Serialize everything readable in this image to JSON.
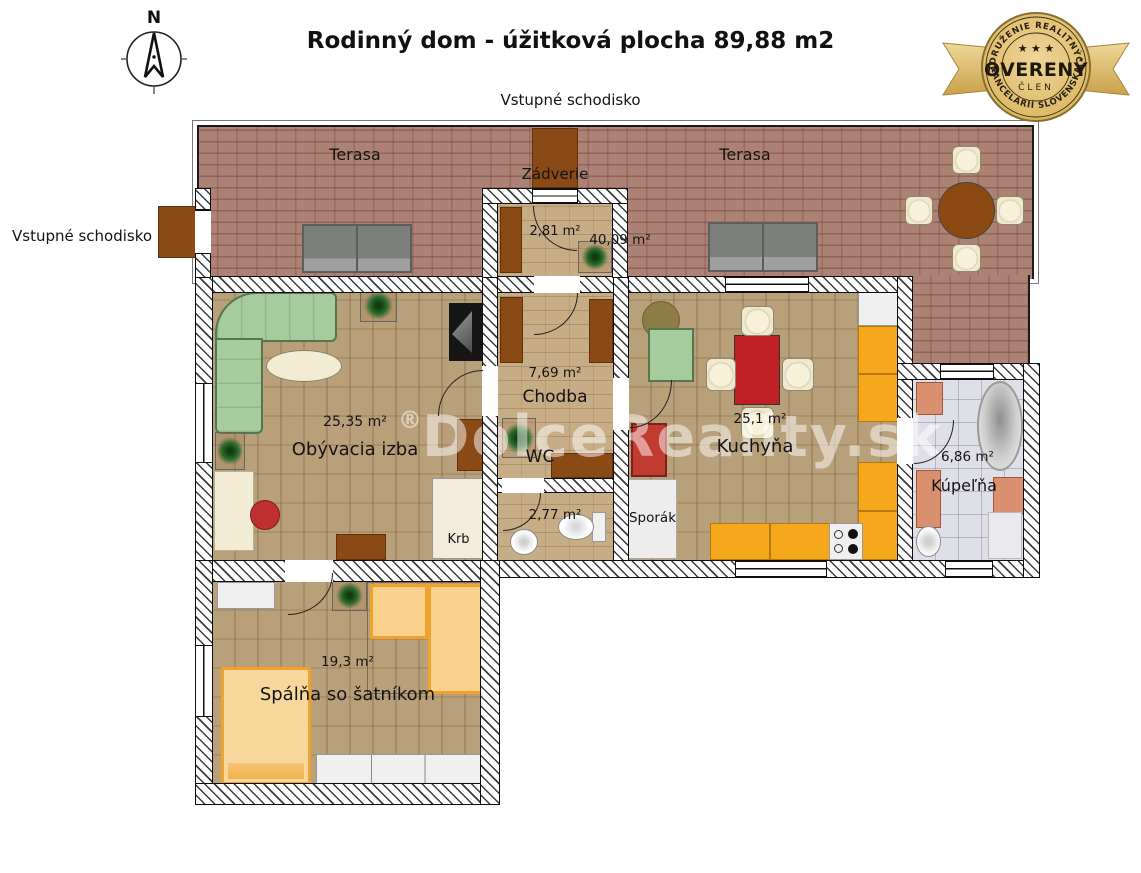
{
  "header": {
    "title": "Rodinný dom - úžitková plocha 89,88 m2",
    "top_label": "Vstupné schodisko",
    "left_label": "Vstupné schodisko",
    "compass_n": "N"
  },
  "badge": {
    "arc_top": "ZDRUŽENIE REALITNÝCH",
    "stars": "★ ★ ★",
    "word": "OVERENÝ",
    "member": "ČLEN",
    "arc_bottom": "KANCELÁRIÍ SLOVENSKA",
    "gold": "#d8b65c"
  },
  "watermark": {
    "reg": "®",
    "text": "DolceReality",
    "tld": ".sk"
  },
  "rooms": {
    "terasa_left": {
      "name": "Terasa"
    },
    "terasa_right": {
      "name": "Terasa",
      "area": "40,09 m²"
    },
    "zadverie": {
      "name": "Zádverie",
      "area": "2,81 m²"
    },
    "obyvacia": {
      "name": "Obývacia izba",
      "area": "25,35 m²"
    },
    "chodba": {
      "name": "Chodba",
      "area": "7,69 m²"
    },
    "wc": {
      "name": "WC",
      "area": "2,77 m²"
    },
    "kuchyna": {
      "name": "Kuchyňa",
      "area": "25,1 m²"
    },
    "kupelna": {
      "name": "Kúpeľňa",
      "area": "6,86 m²"
    },
    "spalna": {
      "name": "Spálňa so šatníkom",
      "area": "19,3 m²"
    }
  },
  "fixtures": {
    "fireplace": "Krb",
    "stove": "Sporák"
  },
  "colors": {
    "terrace_brick": "#a87b6e",
    "wood_floor": "#b49a72",
    "hall_tile": "#c6ad86",
    "bath_tile": "#dfdfe8",
    "kitchen_cabinet": "#f6a81c",
    "furniture_green": "#a6cb9d",
    "accent_red": "#c03030",
    "mat_brown": "#8a4a15"
  }
}
